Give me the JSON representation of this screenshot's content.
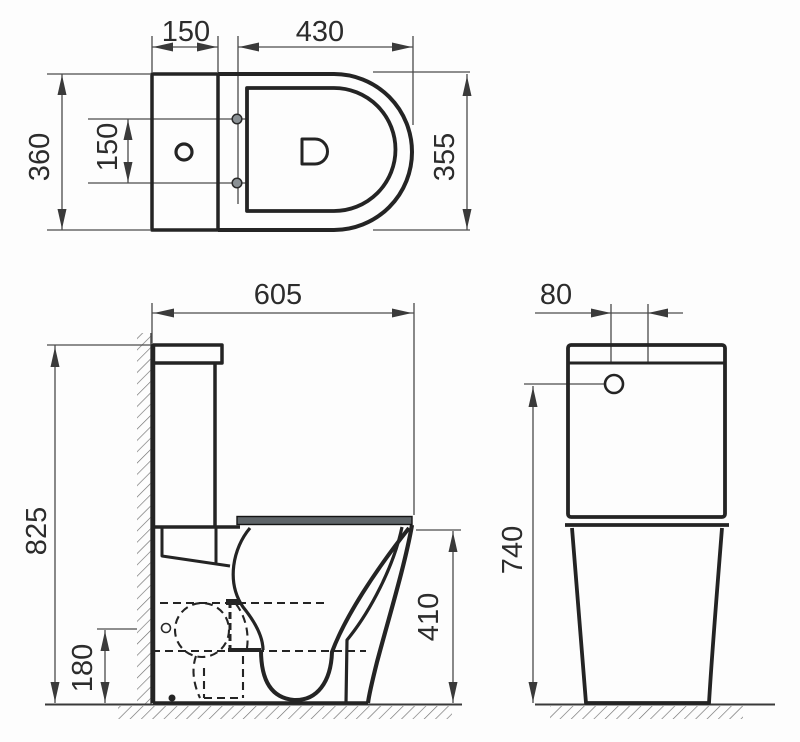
{
  "drawing": {
    "type": "sanitary-ware technical dimension drawing",
    "subject": "close-coupled toilet (WC) with cistern, three orthographic views",
    "colors": {
      "line": "#242424",
      "dim_line": "#4b4b4b",
      "text": "#2c2c2c",
      "seat_fill": "#5e6468",
      "hatch": "#6f6f6f",
      "background": "#fdfdfd"
    }
  },
  "dims": {
    "top": {
      "tank_depth": "150",
      "seat_length": "430",
      "overall_width": "360",
      "hinge_spacing": "150",
      "bowl_width": "355"
    },
    "side": {
      "overall_depth": "605",
      "overall_height": "825",
      "outlet_height": "180",
      "bowl_height": "410"
    },
    "front": {
      "button_offset": "80",
      "tank_height": "740"
    }
  }
}
